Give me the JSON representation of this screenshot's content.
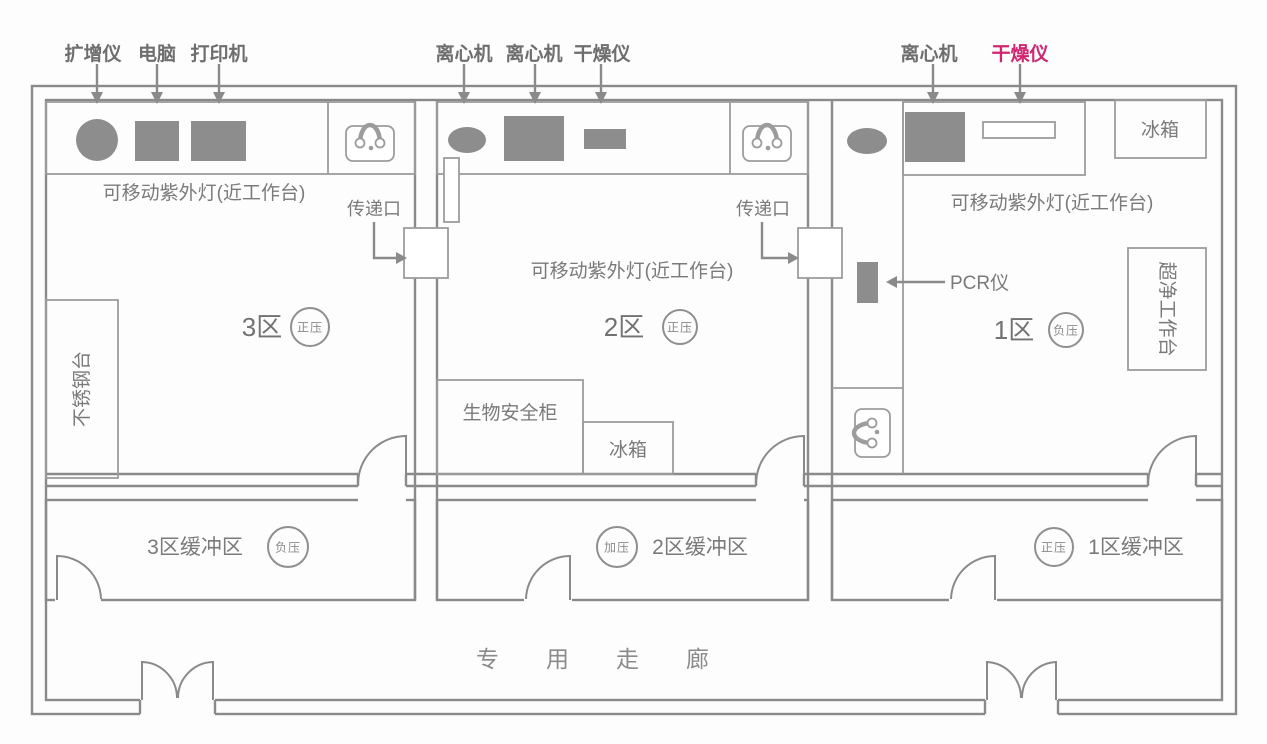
{
  "title": "PCR实验室平面图",
  "colors": {
    "line": "#8a8a8a",
    "equipment_fill": "#8d8d8d",
    "label_text": "#7a7a7a",
    "accent": "#d02670"
  },
  "equipment_labels": {
    "zone3": [
      "扩增仪",
      "电脑",
      "打印机"
    ],
    "zone2": [
      "离心机",
      "离心机",
      "干燥仪"
    ],
    "zone1": [
      "离心机",
      "干燥仪"
    ]
  },
  "rooms": {
    "zone3": {
      "label": "3区",
      "pressure": "正压",
      "uv_note": "可移动紫外灯(近工作台)",
      "bench_side": "不锈钢台"
    },
    "zone2": {
      "label": "2区",
      "pressure": "正压",
      "uv_note": "可移动紫外灯(近工作台)",
      "biosafety": "生物安全柜",
      "fridge": "冰箱"
    },
    "zone1": {
      "label": "1区",
      "pressure": "负压",
      "uv_note": "可移动紫外灯(近工作台)",
      "fridge": "冰箱",
      "clean_bench": "超净工作台",
      "pcr": "PCR仪"
    }
  },
  "pass_window": {
    "label": "传递口"
  },
  "buffers": {
    "buffer3": {
      "label": "3区缓冲区",
      "pressure": "负压"
    },
    "buffer2": {
      "label": "2区缓冲区",
      "pressure": "加压"
    },
    "buffer1": {
      "label": "1区缓冲区",
      "pressure": "正压"
    }
  },
  "corridor": {
    "label": "专用走廊"
  }
}
